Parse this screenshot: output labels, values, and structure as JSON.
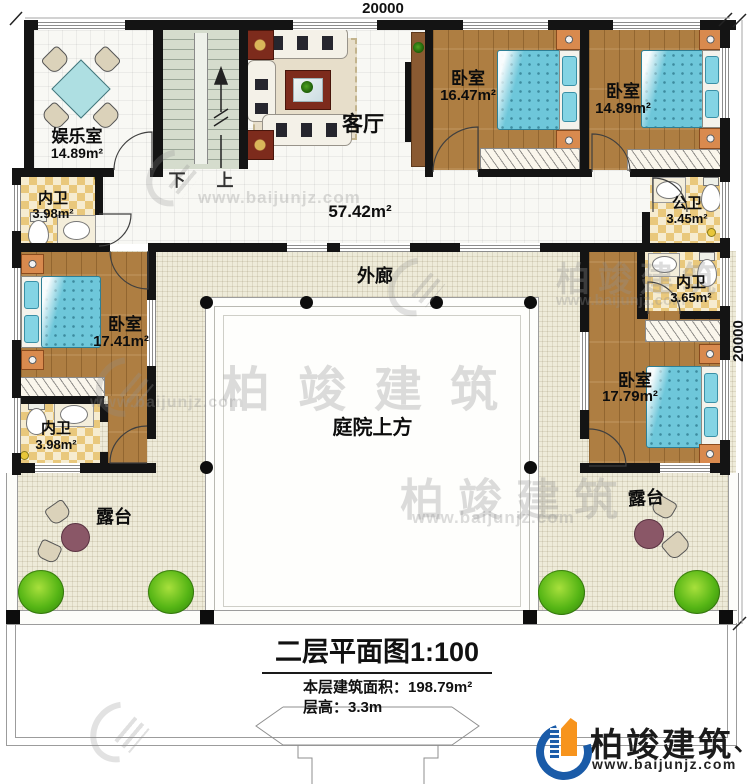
{
  "dimensions": {
    "top": "20000",
    "right": "20000"
  },
  "rooms": {
    "entertainment": {
      "name": "娱乐室",
      "area": "14.89m²"
    },
    "bath_top_left": {
      "name": "内卫",
      "area": "3.98m²"
    },
    "bedroom_left": {
      "name": "卧室",
      "area": "17.41m²"
    },
    "bath_bottom_left": {
      "name": "内卫",
      "area": "3.98m²"
    },
    "living_room": {
      "name": "客厅",
      "area": "57.42m²"
    },
    "bedroom_top_1": {
      "name": "卧室",
      "area": "16.47m²"
    },
    "bedroom_top_2": {
      "name": "卧室",
      "area": "14.89m²"
    },
    "bath_public": {
      "name": "公卫",
      "area": "3.45m²"
    },
    "bath_right": {
      "name": "内卫",
      "area": "3.65m²"
    },
    "bedroom_right": {
      "name": "卧室",
      "area": "17.79m²"
    },
    "corridor": {
      "name": "外廊"
    },
    "courtyard": {
      "name": "庭院上方"
    },
    "terrace_left": {
      "name": "露台"
    },
    "terrace_right": {
      "name": "露台"
    }
  },
  "stairs": {
    "down_label": "下",
    "up_label": "上"
  },
  "title_block": {
    "title": "二层平面图1:100",
    "floor_area_line": "本层建筑面积：198.79m²",
    "floor_height_line": "层高：3.3m"
  },
  "branding": {
    "logo_text": "柏竣建筑",
    "logo_url": "www.baijunjz.com",
    "accent_mark": "、"
  },
  "watermark": {
    "text": "柏竣建筑",
    "url": "www.baijunjz.com"
  },
  "colors": {
    "wall": "#141414",
    "wood_floor": "#ae7e42",
    "tile_gold": "#e9c87c",
    "corridor_floor": "#eeebd9",
    "stair_floor": "#d5dccd",
    "bed_blue": "#6ec7da",
    "logo_blue": "#1a5ba8",
    "logo_orange": "#f7941d"
  }
}
